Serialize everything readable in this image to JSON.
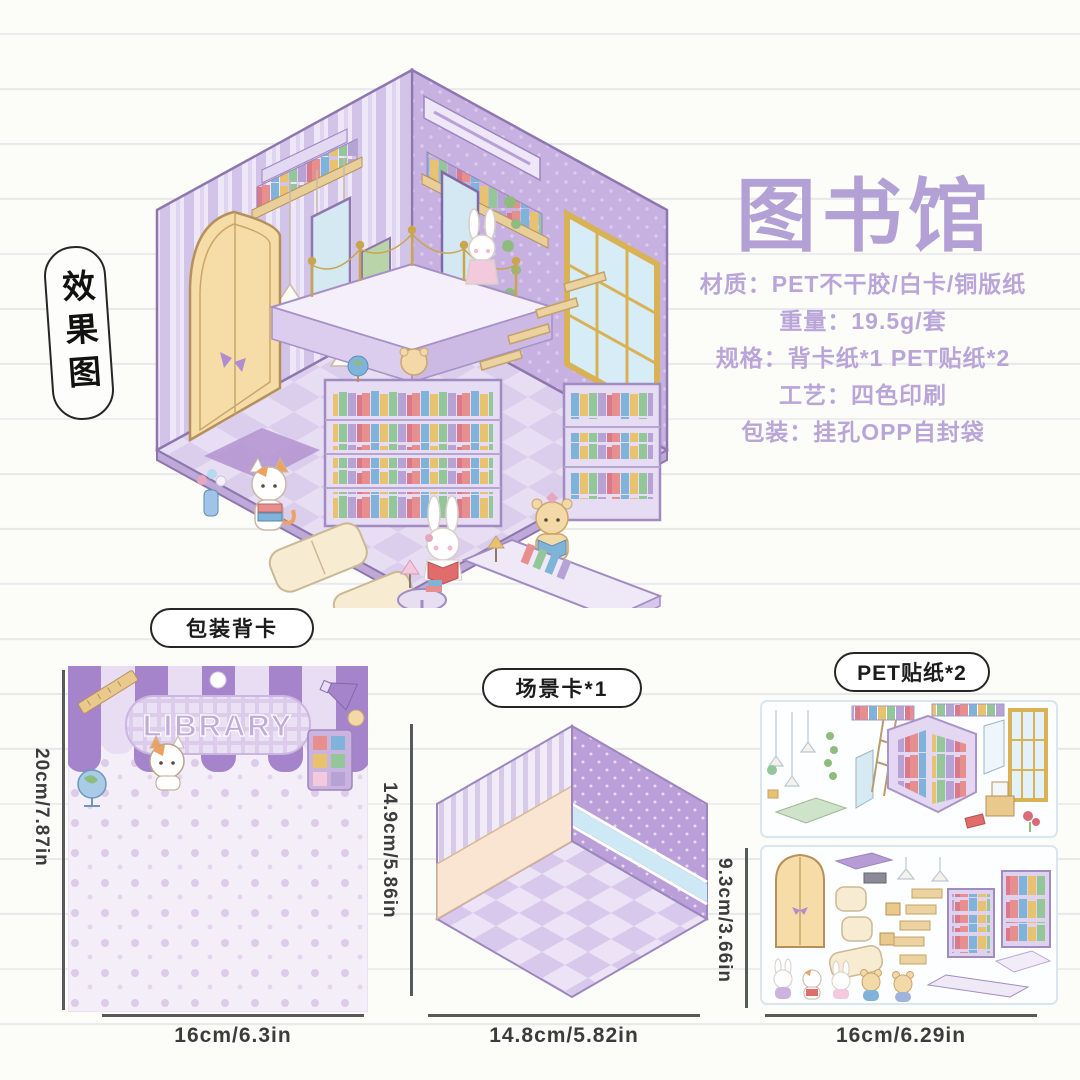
{
  "colors": {
    "accent": "#b7a2d6",
    "title": "#b3a0d4",
    "spec": "#b9a5d8",
    "line": "#e9e9ec",
    "dimline": "#58595b",
    "dimtext": "#3c3c3c",
    "pillborder": "#262626"
  },
  "effect_label": "效果图",
  "product": {
    "title": "图书馆",
    "specs": [
      "材质：PET不干胶/白卡/铜版纸",
      "重量：19.5g/套",
      "规格：背卡纸*1 PET贴纸*2",
      "工艺：四色印刷",
      "包装：挂孔OPP自封袋"
    ]
  },
  "back_card": {
    "label": "包装背卡",
    "banner_text": "LIBRARY",
    "height_dim": "20cm/7.87in",
    "width_dim": "16cm/6.3in"
  },
  "scene_card": {
    "label": "场景卡*1",
    "height_dim": "14.9cm/5.86in",
    "width_dim": "14.8cm/5.82in"
  },
  "stickers": {
    "label": "PET贴纸*2",
    "height_dim": "9.3cm/3.66in",
    "width_dim": "16cm/6.29in"
  }
}
